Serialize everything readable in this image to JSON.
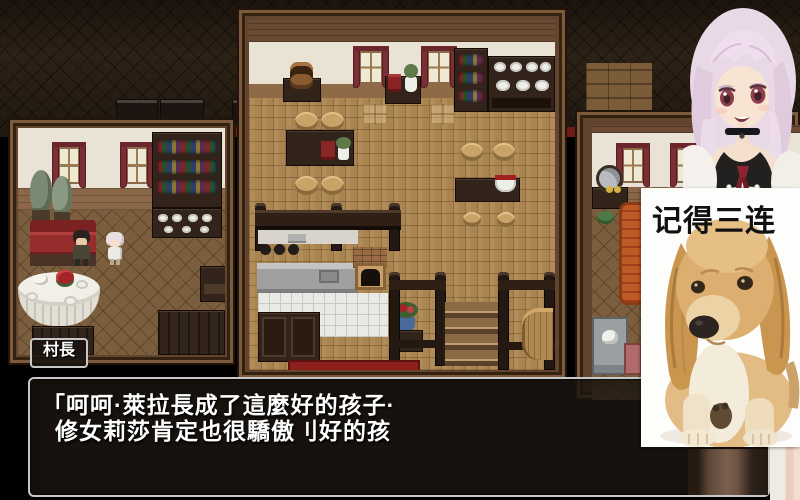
{
  "dialog": {
    "speaker": "村長",
    "line1": "「呵呵·萊拉長成了這麼好的孩子·",
    "line2": "修女莉莎肯定也很驕傲刂好的孩"
  },
  "overlay": {
    "caption": "记得三连"
  },
  "icons": {
    "avatar": "anime-girl-avatar",
    "dog": "golden-puppy-photo"
  },
  "colors": {
    "window_bg": "rgba(28,22,16,0.82)",
    "window_border": "#c7c7c7",
    "text": "#ffffff",
    "caption": "#111111",
    "carpet_red": "#8e1f1c",
    "curtain_red": "#7c2e35",
    "couch_red": "#962c2c",
    "floor_main": "#aa8450",
    "floor_side": "#7b5e3d"
  }
}
